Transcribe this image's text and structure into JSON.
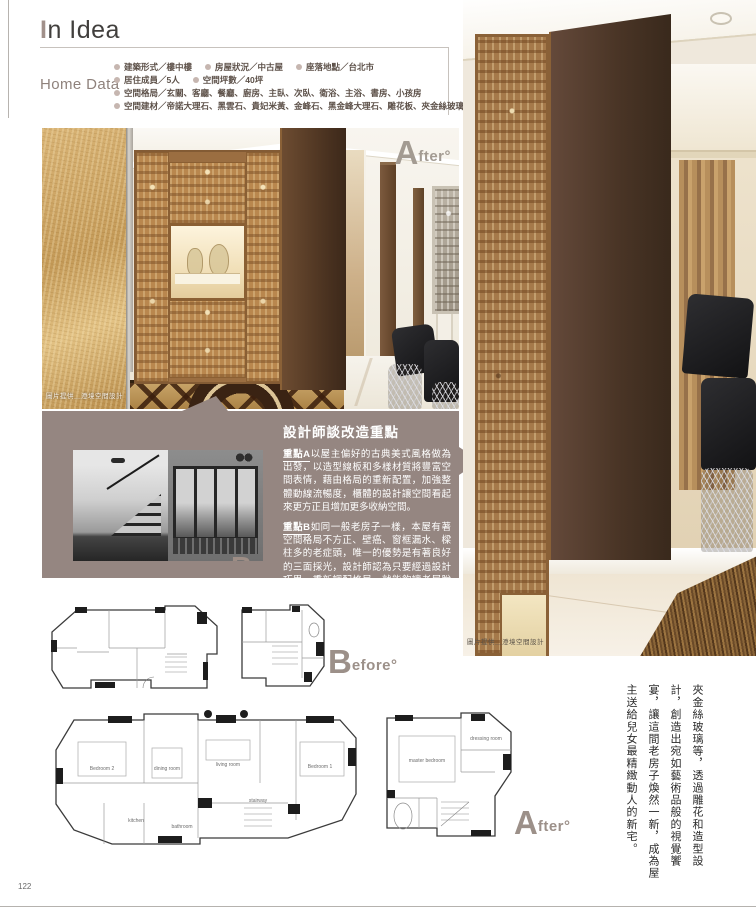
{
  "page": {
    "number": "122"
  },
  "colors": {
    "accent_mauve": "#958681",
    "label_taupe": "#9c9089",
    "gold_wall": "#c9a467",
    "dark_wood": "#4a3526"
  },
  "header": {
    "title_initial": "I",
    "title_rest": "n Idea",
    "home_data_label": "Home Data",
    "items": [
      {
        "label": "建築形式／樓中樓"
      },
      {
        "label": "房屋狀況／中古屋"
      },
      {
        "label": "座落地點／台北市"
      },
      {
        "label": "居住成員／5人"
      },
      {
        "label": "空間坪數／40坪"
      },
      {
        "label": "空間格局／玄關、客廳、餐廳、廚房、主臥、次臥、衛浴、主浴、書房、小孩房"
      },
      {
        "label": "空間建材／帝諾大理石、黑雲石、貴妃米黃、金峰石、黑金峰大理石、雕花板、夾金絲玻璃"
      }
    ]
  },
  "labels": {
    "after_big": "A",
    "after_small": "fter°",
    "before_big": "B",
    "before_small": "efore°"
  },
  "main_photo": {
    "caption": "圖片提供＿澄境空間設計"
  },
  "right_photo": {
    "caption": "圖片提供＿澄境空間設計"
  },
  "designer_box": {
    "title": "設計師談改造重點",
    "para_a_lead": "重點A",
    "para_a_text": "以屋主偏好的古典美式風格做為出發，以造型線板和多樣材質將豐富空間表情，藉由格局的重新配置，加強整體動線流暢度，櫃體的設計讓空間看起來更方正且增加更多收納空間。",
    "para_b_lead": "重點B",
    "para_b_text": "如同一般老房子一樣，本屋有著空間格局不方正、壁癌、窗框漏水、樑柱多的老症頭，唯一的優勢是有著良好的三面採光，設計師認為只要經過設計巧思，重新調配格局，就能夠讓老屋脫胎換骨。"
  },
  "essay": {
    "text": "夾金絲玻璃等，透過雕花和造型設計，創造出宛如藝術品般的視覺饗宴，讓這間老房子煥然一新，成為屋主送給兒女最精緻動人的新宅。"
  },
  "plans": {
    "rooms": {
      "bedroom2": "Bedroom 2",
      "dining": "dining room",
      "living": "living room",
      "bedroom1": "Bedroom 1",
      "kitchen": "kitchen",
      "bathroom": "bathroom",
      "stair": "stairway",
      "master": "master bedroom",
      "dressing": "dressing room"
    }
  }
}
